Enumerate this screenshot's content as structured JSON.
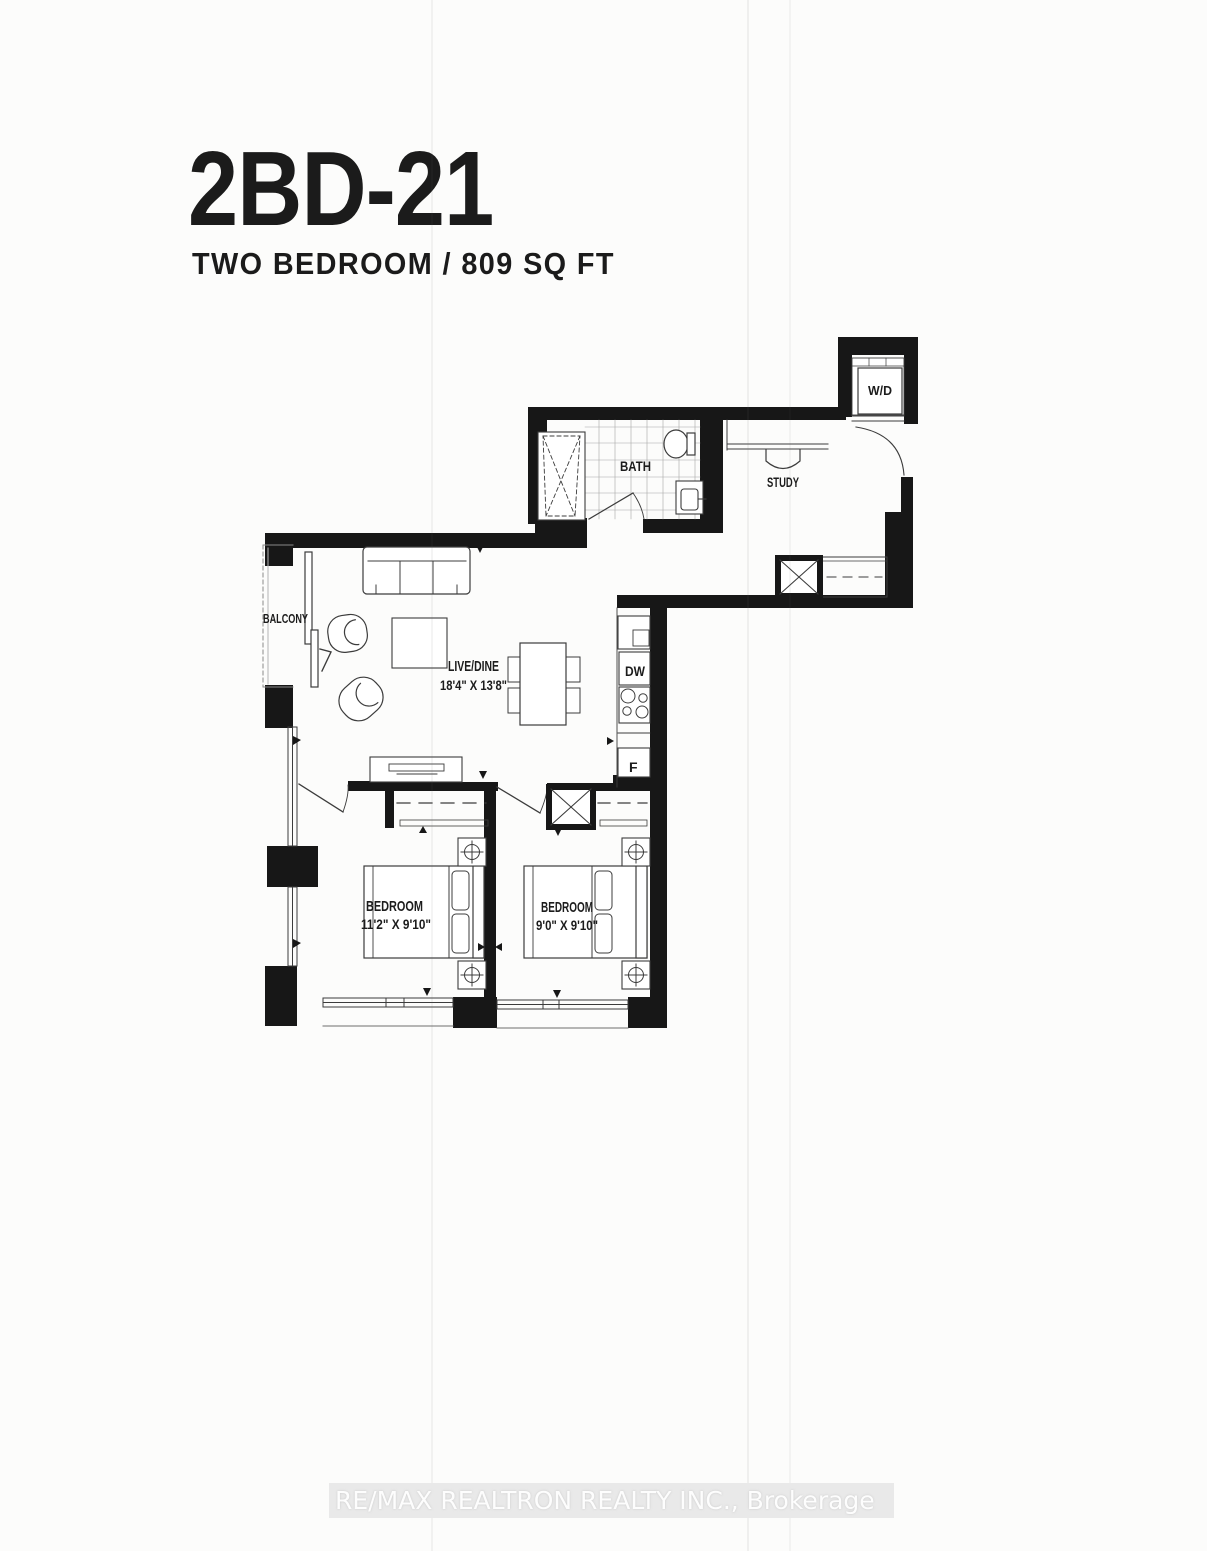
{
  "page": {
    "title": "2BD-21",
    "subtitle": "TWO BEDROOM / 809 SQ FT",
    "watermark": "RE/MAX REALTRON REALTY INC., Brokerage"
  },
  "plan": {
    "labels": {
      "balcony": "BALCONY",
      "live_dine": "LIVE/DINE",
      "live_dine_dims": "18'4\" X 13'8\"",
      "bath": "BATH",
      "study": "STUDY",
      "wd": "W/D",
      "dw": "DW",
      "fridge": "F",
      "bedroom1": "BEDROOM",
      "bedroom1_dims": "11'2\" X 9'10\"",
      "bedroom2": "BEDROOM",
      "bedroom2_dims": "9'0\" X 9'10\""
    },
    "colors": {
      "wall": "#171717",
      "line": "#3c3c3c",
      "paper": "#fcfcfb",
      "watermark_band": "#e9e9e9"
    }
  }
}
